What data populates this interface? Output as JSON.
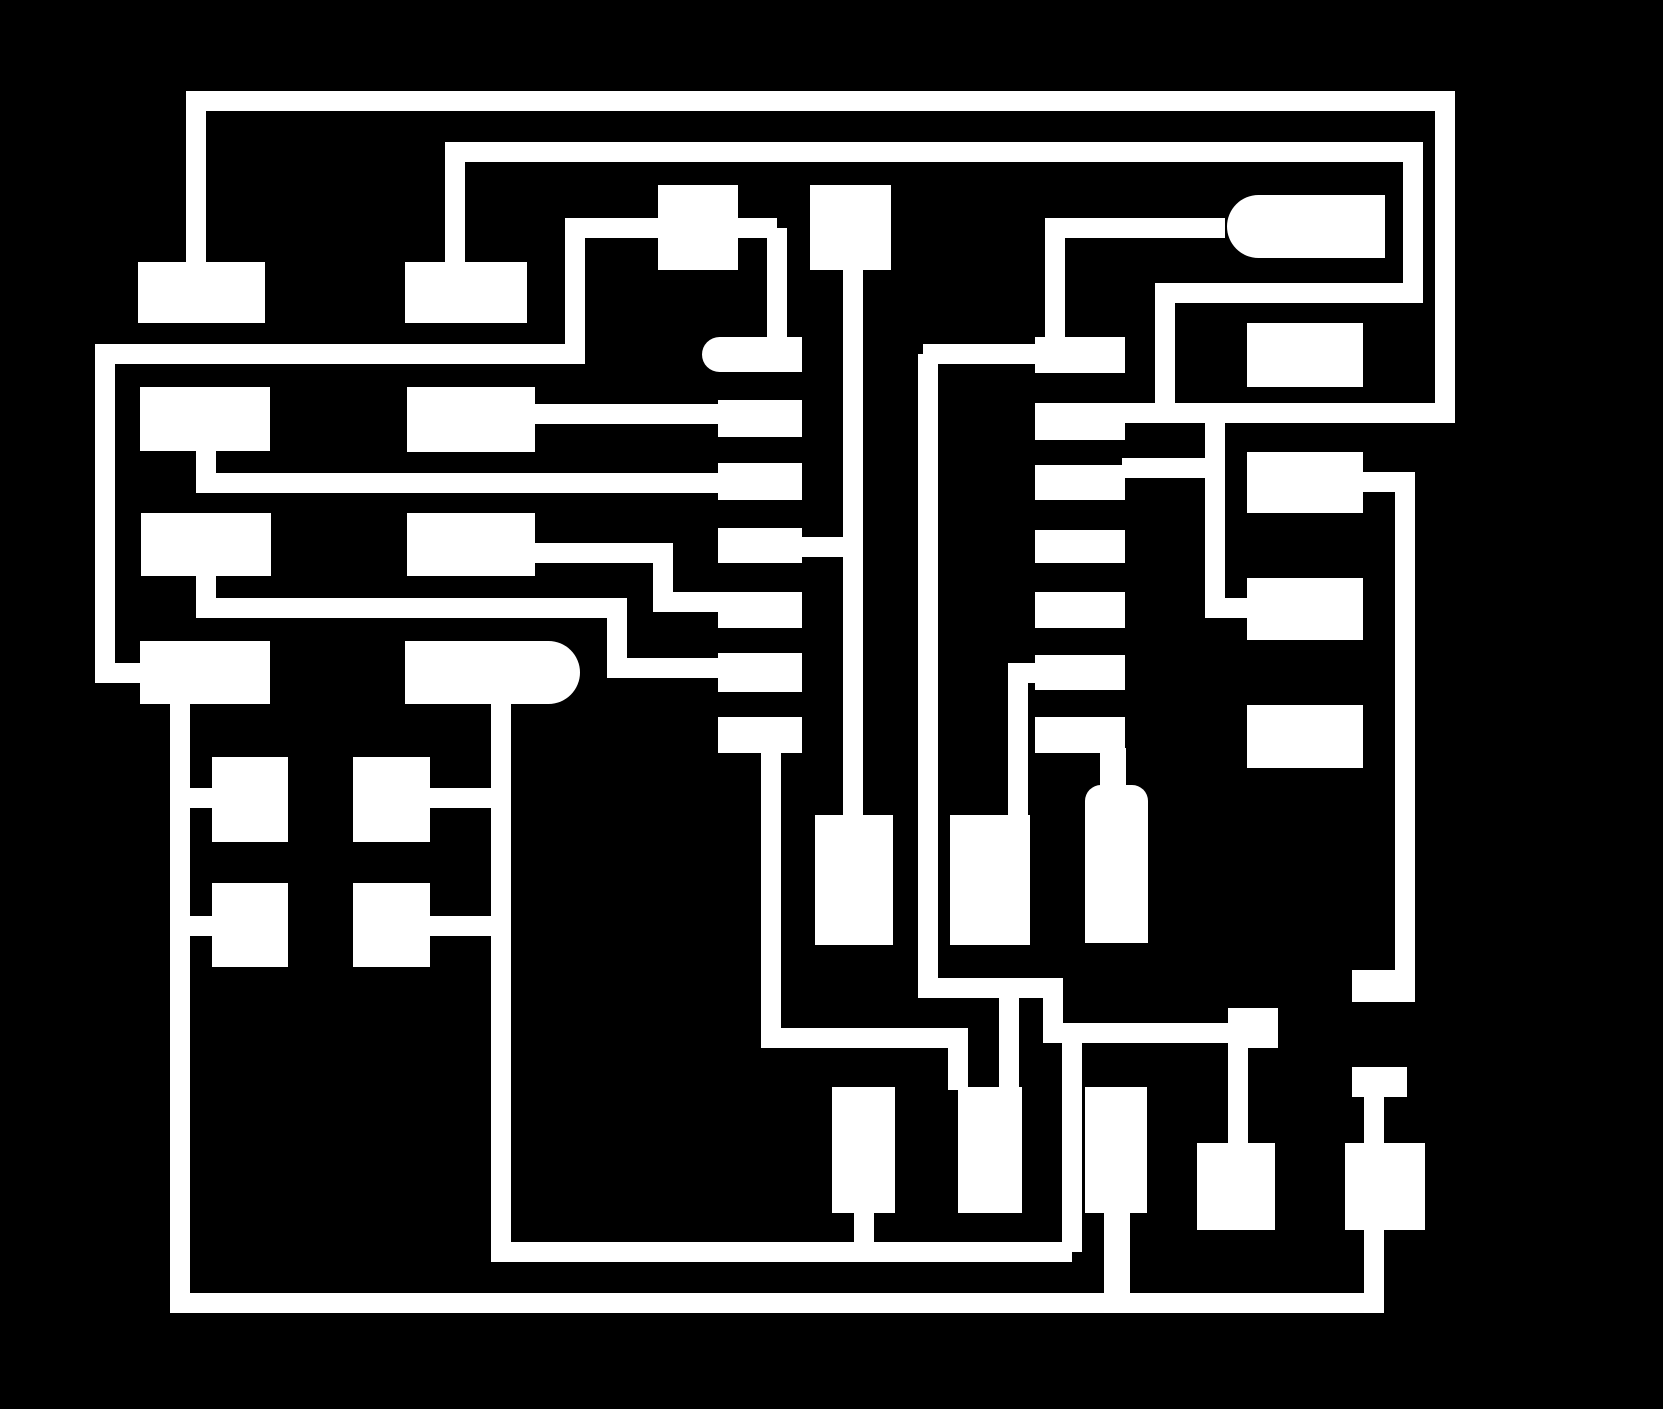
{
  "board": {
    "width": 1663,
    "height": 1409,
    "background_color": "#000000",
    "copper_color": "#ffffff",
    "default_trace_width": 20
  },
  "pads": [
    {
      "name": "lic-left-pad-1",
      "shape": "rect",
      "x": 138,
      "y": 262,
      "w": 127,
      "h": 61
    },
    {
      "name": "lic-left-pad-2",
      "shape": "rect",
      "x": 140,
      "y": 387,
      "w": 130,
      "h": 64
    },
    {
      "name": "lic-left-pad-3",
      "shape": "rect",
      "x": 141,
      "y": 513,
      "w": 130,
      "h": 63
    },
    {
      "name": "lic-left-pad-4",
      "shape": "rect",
      "x": 140,
      "y": 641,
      "w": 130,
      "h": 63
    },
    {
      "name": "lic-right-pad-1",
      "shape": "rect",
      "x": 405,
      "y": 262,
      "w": 122,
      "h": 61
    },
    {
      "name": "lic-right-pad-2",
      "shape": "rect",
      "x": 407,
      "y": 387,
      "w": 128,
      "h": 65
    },
    {
      "name": "lic-right-pad-3",
      "shape": "rect",
      "x": 407,
      "y": 513,
      "w": 128,
      "h": 63
    },
    {
      "name": "lic-right-pad-4-pill",
      "shape": "pill-right",
      "x": 405,
      "y": 641,
      "w": 175,
      "h": 63
    },
    {
      "name": "top-pad-a",
      "shape": "rect",
      "x": 658,
      "y": 185,
      "w": 80,
      "h": 85
    },
    {
      "name": "top-pad-b",
      "shape": "rect",
      "x": 810,
      "y": 185,
      "w": 81,
      "h": 85
    },
    {
      "name": "mid-left-pill-pad-1",
      "shape": "pill-left",
      "x": 702,
      "y": 337,
      "w": 100,
      "h": 35
    },
    {
      "name": "mid-left-pad-2",
      "shape": "rect",
      "x": 718,
      "y": 400,
      "w": 84,
      "h": 37
    },
    {
      "name": "mid-left-pad-3",
      "shape": "rect",
      "x": 718,
      "y": 463,
      "w": 84,
      "h": 37
    },
    {
      "name": "mid-left-pad-4",
      "shape": "rect",
      "x": 718,
      "y": 528,
      "w": 84,
      "h": 35
    },
    {
      "name": "mid-left-pad-5",
      "shape": "rect",
      "x": 718,
      "y": 592,
      "w": 84,
      "h": 36
    },
    {
      "name": "mid-left-pad-6",
      "shape": "rect",
      "x": 718,
      "y": 653,
      "w": 84,
      "h": 39
    },
    {
      "name": "mid-left-pad-7",
      "shape": "rect",
      "x": 718,
      "y": 717,
      "w": 84,
      "h": 36
    },
    {
      "name": "mid-right-pad-1",
      "shape": "rect",
      "x": 1035,
      "y": 337,
      "w": 90,
      "h": 36
    },
    {
      "name": "mid-right-pad-2",
      "shape": "rect",
      "x": 1035,
      "y": 403,
      "w": 90,
      "h": 37
    },
    {
      "name": "mid-right-pad-3",
      "shape": "rect",
      "x": 1035,
      "y": 465,
      "w": 90,
      "h": 35
    },
    {
      "name": "mid-right-pad-4",
      "shape": "rect",
      "x": 1035,
      "y": 530,
      "w": 90,
      "h": 33
    },
    {
      "name": "mid-right-pad-5",
      "shape": "rect",
      "x": 1035,
      "y": 592,
      "w": 90,
      "h": 36
    },
    {
      "name": "mid-right-pad-6",
      "shape": "rect",
      "x": 1035,
      "y": 655,
      "w": 90,
      "h": 35
    },
    {
      "name": "mid-right-pad-7",
      "shape": "rect",
      "x": 1035,
      "y": 717,
      "w": 90,
      "h": 36
    },
    {
      "name": "top-right-pill-pad",
      "shape": "pill-left",
      "x": 1227,
      "y": 195,
      "w": 158,
      "h": 63
    },
    {
      "name": "right-col-pad-1",
      "shape": "rect",
      "x": 1247,
      "y": 323,
      "w": 116,
      "h": 64
    },
    {
      "name": "right-col-pad-2",
      "shape": "rect",
      "x": 1247,
      "y": 452,
      "w": 116,
      "h": 61
    },
    {
      "name": "right-col-pad-3",
      "shape": "rect",
      "x": 1247,
      "y": 578,
      "w": 116,
      "h": 62
    },
    {
      "name": "right-col-pad-4",
      "shape": "rect",
      "x": 1247,
      "y": 705,
      "w": 116,
      "h": 63
    },
    {
      "name": "tall-pad-1",
      "shape": "rect",
      "x": 815,
      "y": 815,
      "w": 78,
      "h": 130
    },
    {
      "name": "tall-pad-2",
      "shape": "rect",
      "x": 950,
      "y": 815,
      "w": 80,
      "h": 130
    },
    {
      "name": "bottle-pad-neck",
      "shape": "rect",
      "x": 1100,
      "y": 748,
      "w": 26,
      "h": 42
    },
    {
      "name": "bottle-pad-body",
      "shape": "round-top",
      "x": 1085,
      "y": 785,
      "w": 63,
      "h": 158
    },
    {
      "name": "square-pad-1",
      "shape": "rect",
      "x": 212,
      "y": 757,
      "w": 76,
      "h": 85
    },
    {
      "name": "square-pad-2",
      "shape": "rect",
      "x": 353,
      "y": 757,
      "w": 77,
      "h": 85
    },
    {
      "name": "square-pad-3",
      "shape": "rect",
      "x": 212,
      "y": 883,
      "w": 76,
      "h": 84
    },
    {
      "name": "square-pad-4",
      "shape": "rect",
      "x": 353,
      "y": 883,
      "w": 77,
      "h": 84
    },
    {
      "name": "bottom-pad-1",
      "shape": "rect",
      "x": 832,
      "y": 1087,
      "w": 63,
      "h": 126
    },
    {
      "name": "bottom-pad-2",
      "shape": "rect",
      "x": 958,
      "y": 1087,
      "w": 64,
      "h": 126
    },
    {
      "name": "bottom-pad-3",
      "shape": "rect",
      "x": 1085,
      "y": 1087,
      "w": 62,
      "h": 126
    },
    {
      "name": "bottom-pad-4",
      "shape": "rect",
      "x": 1197,
      "y": 1143,
      "w": 78,
      "h": 87
    },
    {
      "name": "bottom-pad-5",
      "shape": "rect",
      "x": 1345,
      "y": 1143,
      "w": 80,
      "h": 87
    },
    {
      "name": "step-end-block",
      "shape": "rect",
      "x": 1228,
      "y": 1008,
      "w": 50,
      "h": 40
    },
    {
      "name": "right-trace-end-block",
      "shape": "rect",
      "x": 1352,
      "y": 970,
      "w": 63,
      "h": 32
    },
    {
      "name": "terminal-block-2",
      "shape": "rect",
      "x": 1352,
      "y": 1067,
      "w": 55,
      "h": 30
    }
  ],
  "traces": [
    {
      "name": "trace-top-loop",
      "d": "M196,262 L196,101 L1445,101 L1445,413 L1125,413"
    },
    {
      "name": "trace-top-loop-branch-v",
      "d": "M1215,403 L1215,608 L1252,608"
    },
    {
      "name": "trace-top-loop-branch-h",
      "d": "M1122,468 L1225,468"
    },
    {
      "name": "trace-second-top",
      "d": "M455,262 L455,152 L1413,152 L1413,293 L1165,293 L1165,404"
    },
    {
      "name": "trace-third-left",
      "d": "M95,354 L585,354"
    },
    {
      "name": "trace-third-right",
      "d": "M923,354 L1040,354"
    },
    {
      "name": "trace-left-edge",
      "d": "M105,344 L105,673 L145,673"
    },
    {
      "name": "trace-t4-vertical",
      "d": "M575,364 L575,228"
    },
    {
      "name": "trace-t4-horizontal",
      "d": "M565,228 L777,228"
    },
    {
      "name": "trace-t4-drop",
      "d": "M777,228 L777,340"
    },
    {
      "name": "trace-pad2-connect",
      "d": "M520,414 L722,414"
    },
    {
      "name": "trace-a2-row",
      "d": "M206,450 L206,483 L722,483"
    },
    {
      "name": "trace-a3-step",
      "d": "M206,575 L206,608 L617,608 L617,668 L722,668"
    },
    {
      "name": "trace-b3-step",
      "d": "M520,553 L663,553 L663,602 L722,602"
    },
    {
      "name": "trace-center-v1",
      "d": "M853,266 L853,818"
    },
    {
      "name": "trace-pad4-connect",
      "d": "M798,547 L853,547"
    },
    {
      "name": "trace-center-v2-step",
      "d": "M928,354 L928,988 L1053,988 L1053,1033"
    },
    {
      "name": "trace-step-right",
      "d": "M1043,1033 L1238,1033"
    },
    {
      "name": "trace-h2-riser",
      "d": "M1072,1033 L1072,1252"
    },
    {
      "name": "trace-bp2-drop",
      "d": "M1009,998 L1009,1090"
    },
    {
      "name": "trace-ric-pad1-up",
      "d": "M1055,340 L1055,228 L1225,228"
    },
    {
      "name": "trace-pad6-drop",
      "d": "M1040,673 L1018,673 L1018,818"
    },
    {
      "name": "trace-bottom-bus-upper",
      "d": "M501,702 L501,1252 L1072,1252"
    },
    {
      "name": "trace-bp1-stub",
      "d": "M864,1210 L864,1248"
    },
    {
      "name": "trace-pad7-net",
      "d": "M771,750 L771,1038 L958,1038 L958,1090"
    },
    {
      "name": "trace-bottom-bus-lower",
      "d": "M180,700 L180,1303 L1374,1303 L1374,1078"
    },
    {
      "name": "trace-right-vertical",
      "d": "M1360,482 L1405,482 L1405,985"
    },
    {
      "name": "trace-square-conn-1",
      "d": "M190,798 L216,798"
    },
    {
      "name": "trace-square-conn-2",
      "d": "M428,798 L505,798"
    },
    {
      "name": "trace-square-conn-3",
      "d": "M190,926 L216,926"
    },
    {
      "name": "trace-square-conn-4",
      "d": "M428,926 L505,926"
    },
    {
      "name": "trace-bp3-stub",
      "d": "M1117,1210 L1117,1300",
      "w": 26
    },
    {
      "name": "trace-bp4-stub",
      "d": "M1238,1046 L1238,1148"
    }
  ]
}
